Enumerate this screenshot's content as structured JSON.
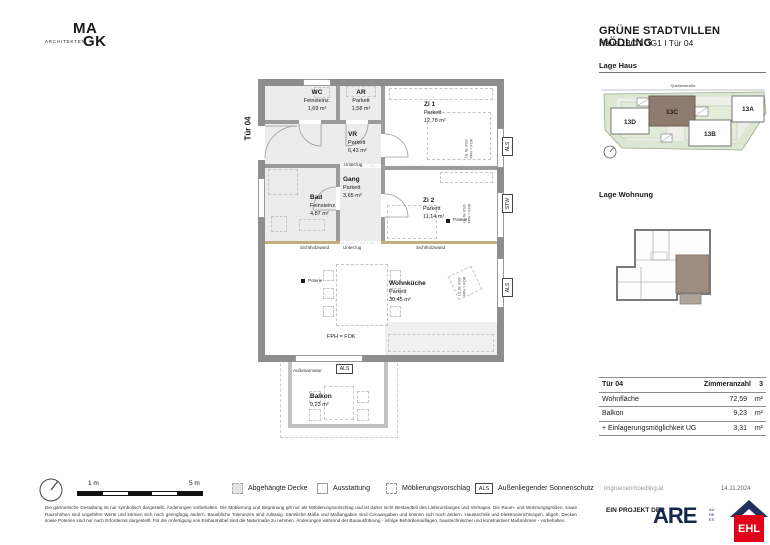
{
  "brand": {
    "architekten": "ARCHITEKTEN",
    "ma": "MA",
    "gk": "GK"
  },
  "header": {
    "project": "GRÜNE STADTVILLEN MÖDLING",
    "unit": "Haus 13C I OG1 I Tür 04"
  },
  "lage_haus": {
    "title": "Lage Haus",
    "street": "Quellenstraße",
    "houses": [
      "13D",
      "13C",
      "13B",
      "13A"
    ]
  },
  "lage_wohnung": {
    "title": "Lage Wohnung"
  },
  "rooms": [
    {
      "name": "WC",
      "floor": "Feinsteinz.",
      "area": "1,69 m²"
    },
    {
      "name": "AR",
      "floor": "Parkett",
      "area": "1,58 m²"
    },
    {
      "name": "Zi 1",
      "floor": "Parkett",
      "area": "12,78 m²"
    },
    {
      "name": "VR",
      "floor": "Parkett",
      "area": "6,43 m²"
    },
    {
      "name": "Bad",
      "floor": "Feinsteinz.",
      "area": "4,87 m²"
    },
    {
      "name": "Gang",
      "floor": "Parkett",
      "area": "3,65 m²"
    },
    {
      "name": "Zi 2",
      "floor": "Parkett",
      "area": "11,14 m²"
    },
    {
      "name": "Wohnküche",
      "floor": "Parkett",
      "area": "30,45 m²"
    },
    {
      "name": "Balkon",
      "floor": "",
      "area": "9,23 m²"
    }
  ],
  "plan": {
    "tuer": "Tür 04",
    "unterzug": "Unterzug",
    "sichtholzwand": "Sichtholzwand",
    "poterie": "Poterie",
    "fph_fok": "FPH = FOK",
    "aussenarmatur": "Außenarmatur",
    "als": "ALS",
    "stw": "STW",
    "window_note_1": "UL fix VSG",
    "window_note_2": "FPH = FOK"
  },
  "table": {
    "door": "Tür  04",
    "rooms_label": "Zimmeranzahl",
    "rooms_value": "3",
    "rows": [
      {
        "label": "Wohnfläche",
        "value": "72,59",
        "unit": "m²"
      },
      {
        "label": "Balkon",
        "value": "9,23",
        "unit": "m²"
      },
      {
        "label": "+ Einlagerungsmöglichkeit UG",
        "value": "3,31",
        "unit": "m²"
      }
    ]
  },
  "legend": {
    "scale_1": "1 m",
    "scale_5": "5 m",
    "items": [
      "Abgehängte Decke",
      "Ausstattung",
      "Möblierungsvorschlag"
    ],
    "als": "ALS",
    "als_text": "Außenliegender Sonnenschutz",
    "website": "imgruenenmoedling.at",
    "date": "14.11.2024"
  },
  "footer": {
    "disclaimer": "Die gärtnerische Gestaltung ist nur symbolisch dargestellt. Änderungen vorbehalten. Die Möblierung und Begrünung gilt nur als Möblierungsvorschlag und ist daher nicht Bestandteil des Lieferumfanges und Vertrages. Die Raum- und Wohnungsgrößen, sowie Raumhöhen sind ungefähre Werte und können sich noch geringfügig ändern. Bauübliche Toleranzen sind zulässig. Sämtliche Maße und Maßangaben sind Circaangaben und können sich noch ändern. Haustechnik und Elektroeinrichtungen, abgeh. Decken sowie Poterien sind nur nach Erfordernis dargestellt. Für die Anfertigung von Einbaumöbel sind die Naturmaße zu nehmen. Änderungen während der Bauausführung - infolge Behördenauflagen, haustechnischer und konstruktiver Maßnahmen - vorbehalten.",
    "project_of": "EIN PROJEKT DER",
    "are": "ARE",
    "are_sub": [
      "AU",
      "RE",
      "ES"
    ],
    "ehl": "EHL"
  },
  "colors": {
    "highlight_brown": "#8d7b6d",
    "unit_brown": "#9c8d83",
    "site_green": "#dce6d2",
    "ehl_red": "#e2001a",
    "logo_navy": "#16294d",
    "wall_gray": "#8d8d8d"
  }
}
